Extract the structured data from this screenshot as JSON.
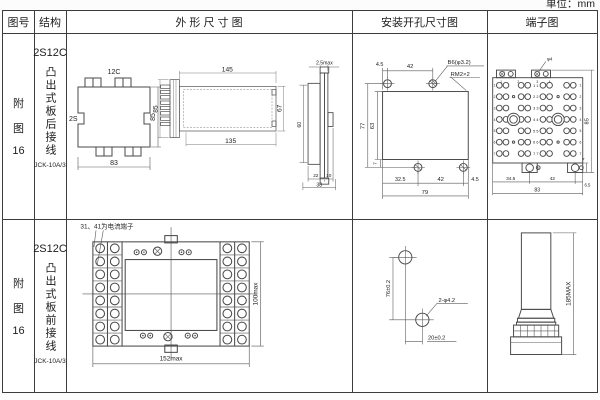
{
  "page": {
    "unit_note": "单位：mm"
  },
  "header": {
    "fig_no": "图号",
    "structure": "结构",
    "outline": "外 形 尺 寸 图",
    "mounting": "安装开孔尺寸图",
    "terminal": "端子图"
  },
  "row1": {
    "fig": [
      "附",
      "图",
      "16"
    ],
    "model": "2S12C",
    "structure_text": "凸出式板后接线",
    "product_code": "JCK-10A/3",
    "topview": {
      "top_label": "12C",
      "side_label": "2S",
      "height": "85",
      "width": "83"
    },
    "sideview": {
      "height": "85",
      "length_top": "145",
      "length_bottom": "135",
      "inner_height": "67"
    },
    "profile": {
      "thickness": "2.5max",
      "height": "60",
      "depth1": "22",
      "depth2": "10",
      "depth_total": "38"
    },
    "mounting": {
      "top1": "4.5",
      "top2": "42",
      "hole_label": "B6(φ3.2)",
      "thread_label": "RM2×2",
      "height_outer": "77",
      "height_inner": "63",
      "offset": "7",
      "bottom1": "32.5",
      "bottom2": "42",
      "bottom3": "4.5",
      "bottom_total": "79"
    },
    "terminal": {
      "hole_label": "φ4",
      "height": "85",
      "tab_height": "4",
      "bottom1": "34.5",
      "bottom2": "42",
      "bottom3": "6.5",
      "bottom_total": "83",
      "row_nums": [
        "1",
        "2",
        "3",
        "4",
        "5",
        "6",
        "7"
      ],
      "pair_nums": [
        "1 1",
        "2 2",
        "3 3",
        "4 4",
        "5 5",
        "6 6",
        "7 7"
      ],
      "col_nums": [
        "1",
        "2",
        "3",
        "4"
      ]
    }
  },
  "row2": {
    "fig": [
      "附",
      "图",
      "16"
    ],
    "model": "2S12C",
    "structure_text": "凸出式板前接线",
    "product_code": "JCK-10A/3",
    "frontview": {
      "note": "31、41为电流端子",
      "width": "152max",
      "height": "100max"
    },
    "mounting": {
      "vertical": "76±0.2",
      "horizontal": "20±0.2",
      "hole_label": "2-φ4.2"
    },
    "sideview": {
      "height": "185MAX"
    }
  }
}
